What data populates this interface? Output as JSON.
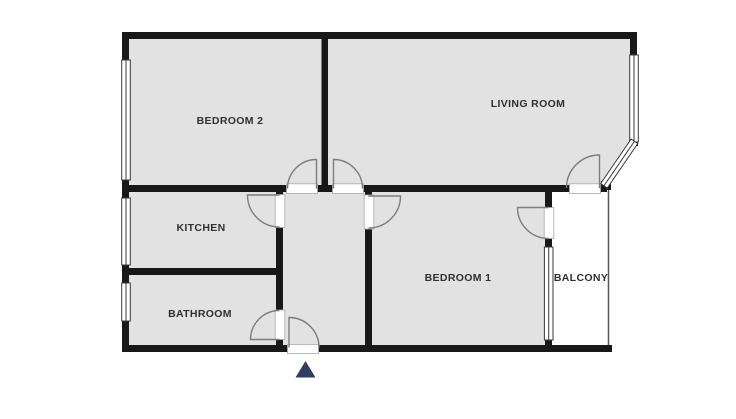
{
  "rooms": [
    {
      "id": "bedroom2",
      "label": "BEDROOM 2"
    },
    {
      "id": "living_room",
      "label": "LIVING ROOM"
    },
    {
      "id": "kitchen",
      "label": "KITCHEN"
    },
    {
      "id": "bathroom",
      "label": "BATHROOM"
    },
    {
      "id": "bedroom1",
      "label": "BEDROOM 1"
    },
    {
      "id": "balcony",
      "label": "BALCONY"
    }
  ],
  "icons": {
    "entrance_arrow": "up-triangle-entrance-marker"
  },
  "colors": {
    "wall": "#181818",
    "room_fill": "#e2e2e2",
    "balcony_fill": "#ffffff",
    "door_arc": "#7d7d7d",
    "window_border": "#3a3a3a",
    "door_gap_border": "#ababab",
    "label_text": "#303030",
    "entrance_arrow": "#2d3f5e",
    "balcony_edge": "#555555"
  }
}
